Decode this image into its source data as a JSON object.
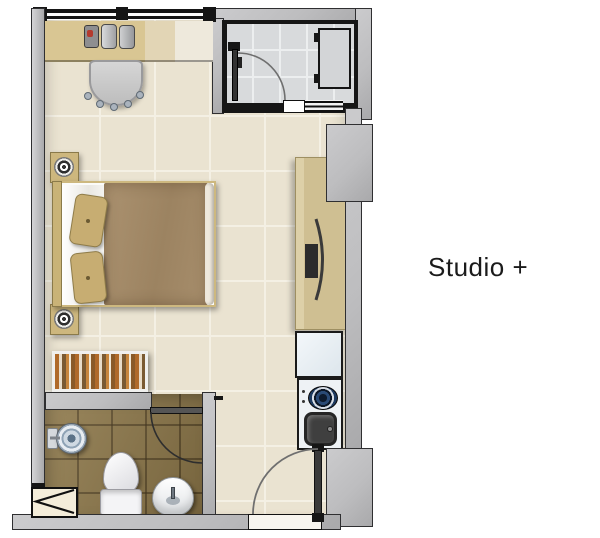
{
  "title": "Studio +",
  "colors": {
    "wall_fill": "#bdbdbf",
    "wall_stroke": "#2f2f31",
    "frame_black": "#161616",
    "floor": "#eae3d1",
    "floor_grout": "#f4f0e4",
    "balcony_tile": "#d8dadc",
    "bath_tile": "#8d7748",
    "wood": "#d9c693",
    "wood_dark": "#cfbf92",
    "blanket": "#a18866",
    "pillow": "#c7ad72",
    "white_fixture": "#f4f4f6",
    "appliance": "#eef2f5",
    "burner": "#1d3a5f",
    "sink_metal": "#3f3f3f",
    "text": "#1b1b1b"
  },
  "symbols": [
    "window",
    "desk",
    "books",
    "desk-chair",
    "nightstand-lamp",
    "double-bed",
    "pillows",
    "wardrobe",
    "tv-console",
    "balcony-door",
    "glass-panel",
    "refrigerator",
    "cooktop-burner",
    "kitchen-sink",
    "bathroom-door",
    "shower-head",
    "toilet",
    "washbasin",
    "vent-shaft",
    "entrance-door"
  ]
}
